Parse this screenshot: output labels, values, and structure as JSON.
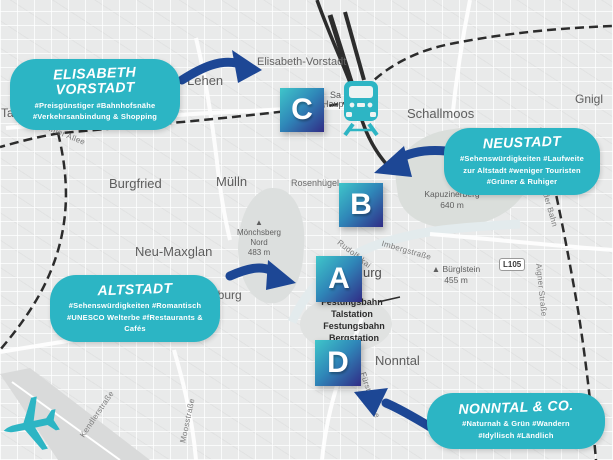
{
  "style": {
    "bubble_color": "#2cb5c4",
    "arrow_color": "#1d4795",
    "marker_gradient": [
      "#3fc6ca",
      "#2f86b8",
      "#312c86"
    ],
    "marker_text_color": "#ffffff",
    "map_background": "#e9eaea",
    "icon_color": "#2db5c4"
  },
  "icons": {
    "station": "train-icon",
    "airport": "airplane-icon"
  },
  "markers": [
    {
      "letter": "A"
    },
    {
      "letter": "B"
    },
    {
      "letter": "C"
    },
    {
      "letter": "D"
    }
  ],
  "callouts": [
    {
      "title": "ELISABETH VORSTADT",
      "tags": "#Preisgünstiger #Bahnhofsnähe\n#Verkehrsanbindung & Shopping"
    },
    {
      "title": "NEUSTADT",
      "tags": "#Sehenswürdigkeiten #Laufweite\nzur Altstadt #weniger Touristen\n#Grüner & Ruhiger"
    },
    {
      "title": "ALTSTADT",
      "tags": "#Sehenswürdigkeiten #Romantisch\n#UNESCO Welterbe #fRestaurants &\nCafés"
    },
    {
      "title": "NONNTAL & CO.",
      "tags": "#Naturnah & Grün #Wandern\n#Idyllisch #Ländlich"
    }
  ],
  "map": {
    "labels": [
      {
        "text": "Elisabeth-Vorstadt"
      },
      {
        "text": "Lehen"
      },
      {
        "text": "Schallmoos"
      },
      {
        "text": "Gnigl"
      },
      {
        "text": "Taxham"
      },
      {
        "text": "Kleßheimer Allee"
      },
      {
        "text": "Burgfried"
      },
      {
        "text": "Mülln"
      },
      {
        "text": "Rosenhügel"
      },
      {
        "text": "Kapuzinerberg\n640 m"
      },
      {
        "text": "▲\nMönchsberg\nNord\n483 m"
      },
      {
        "text": "Neu-Maxglan"
      },
      {
        "text": "Rudolfskai"
      },
      {
        "text": "Imbergstraße"
      },
      {
        "text": "▲ Bürglstein\n455 m"
      },
      {
        "text": "L105"
      },
      {
        "text": "urg"
      },
      {
        "text": "nburg"
      },
      {
        "text": "Festungsbahn\nTalstation"
      },
      {
        "text": "Festungsbahn\nBergstation"
      },
      {
        "text": "Nonntal"
      },
      {
        "text": "Fürstenallee"
      },
      {
        "text": "Kendlerstraße"
      },
      {
        "text": "Moosstraße"
      },
      {
        "text": "rder Bahn"
      },
      {
        "text": "Aigner Straße"
      },
      {
        "text": "Haup"
      },
      {
        "text": "Sa"
      }
    ]
  }
}
